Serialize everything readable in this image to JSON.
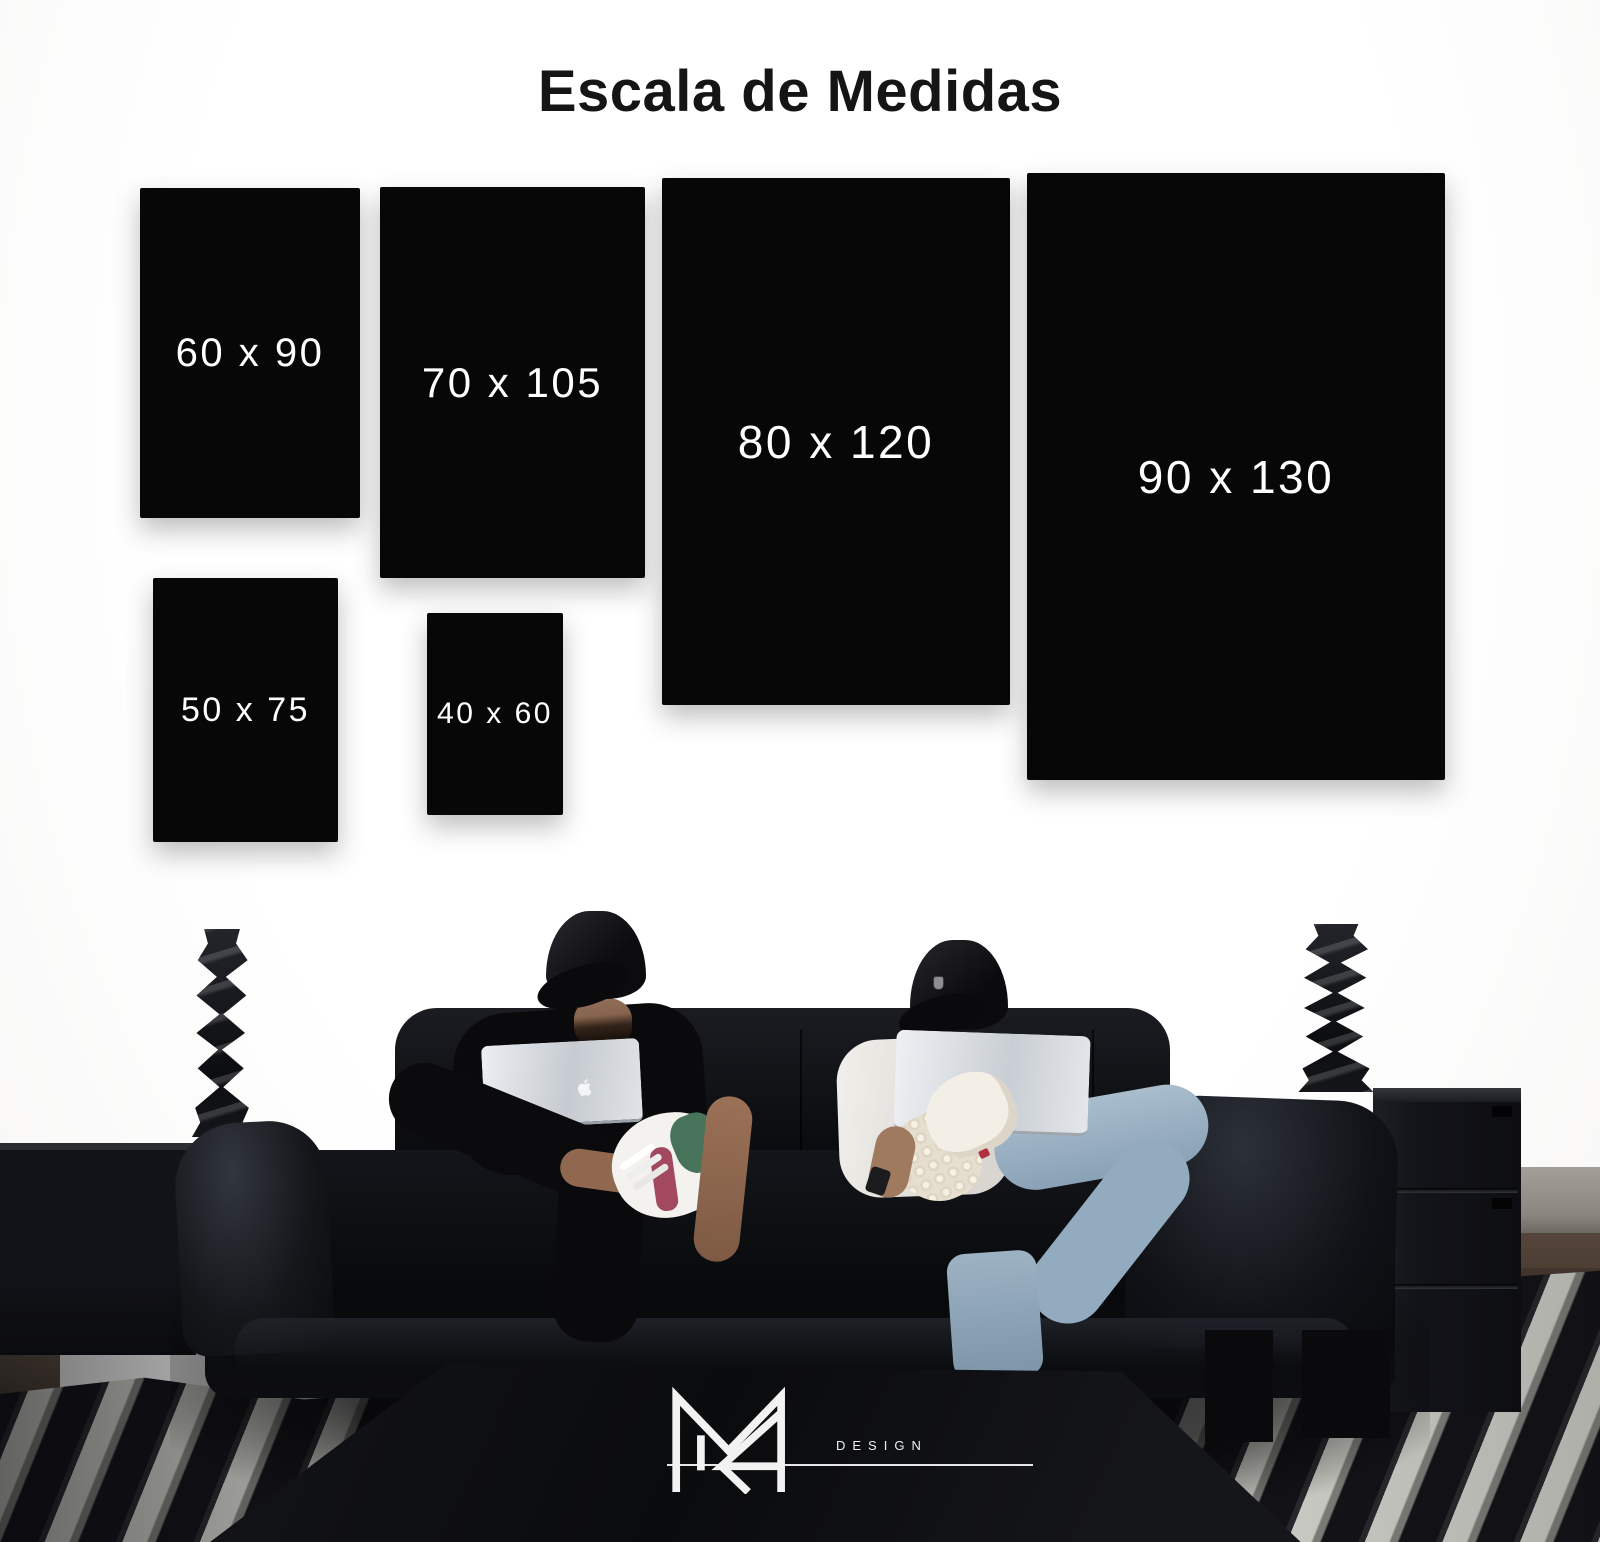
{
  "title": "Escala de Medidas",
  "sizes": [
    {
      "label": "60 x 90",
      "width_cm": 60,
      "height_cm": 90
    },
    {
      "label": "70 x 105",
      "width_cm": 70,
      "height_cm": 105
    },
    {
      "label": "80 x 120",
      "width_cm": 80,
      "height_cm": 120
    },
    {
      "label": "90 x 130",
      "width_cm": 90,
      "height_cm": 130
    },
    {
      "label": "50 x 75",
      "width_cm": 50,
      "height_cm": 75
    },
    {
      "label": "40 x 60",
      "width_cm": 40,
      "height_cm": 60
    }
  ],
  "brand": {
    "wordmark": "DESIGN"
  },
  "colors": {
    "wall": "#fbfbfa",
    "panel": "#070708",
    "panel_label": "#ffffff",
    "title_text": "#151515",
    "logo": "#f2f2f2",
    "couch_leather": "#0b0c0f",
    "jeans": "#9db3c6",
    "rug_stripe_light": "#d4d4cd",
    "rug_stripe_dark": "#131318"
  }
}
